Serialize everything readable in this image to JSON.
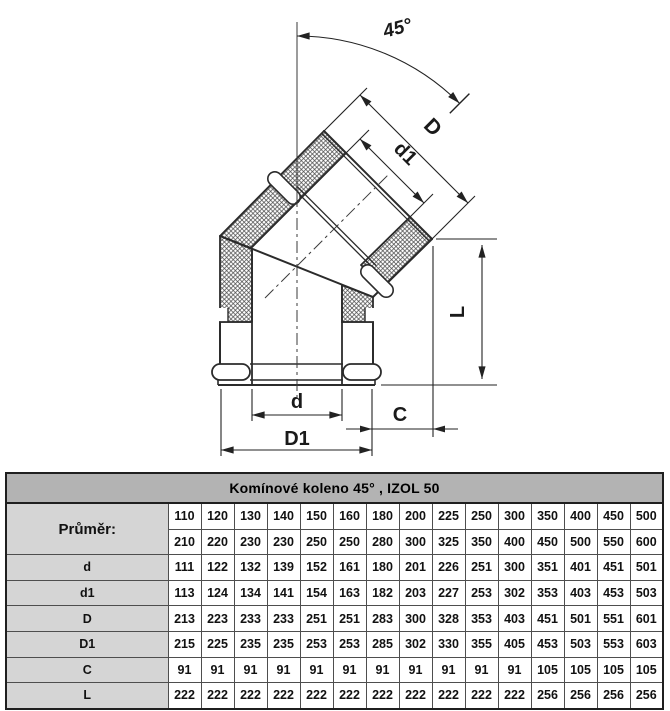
{
  "drawing": {
    "labels": {
      "angle": "45°",
      "D": "D",
      "d1": "d1",
      "d": "d",
      "D1": "D1",
      "C": "C",
      "L": "L"
    }
  },
  "table": {
    "title": "Komínové koleno 45° , IZOL 50",
    "rows": [
      {
        "label": "Průměr:",
        "rowspan": 2,
        "main": true,
        "values": [
          "110",
          "120",
          "130",
          "140",
          "150",
          "160",
          "180",
          "200",
          "225",
          "250",
          "300",
          "350",
          "400",
          "450",
          "500"
        ]
      },
      {
        "label": null,
        "values": [
          "210",
          "220",
          "230",
          "230",
          "250",
          "250",
          "280",
          "300",
          "325",
          "350",
          "400",
          "450",
          "500",
          "550",
          "600"
        ]
      },
      {
        "label": "d",
        "values": [
          "111",
          "122",
          "132",
          "139",
          "152",
          "161",
          "180",
          "201",
          "226",
          "251",
          "300",
          "351",
          "401",
          "451",
          "501"
        ]
      },
      {
        "label": "d1",
        "values": [
          "113",
          "124",
          "134",
          "141",
          "154",
          "163",
          "182",
          "203",
          "227",
          "253",
          "302",
          "353",
          "403",
          "453",
          "503"
        ]
      },
      {
        "label": "D",
        "values": [
          "213",
          "223",
          "233",
          "233",
          "251",
          "251",
          "283",
          "300",
          "328",
          "353",
          "403",
          "451",
          "501",
          "551",
          "601"
        ]
      },
      {
        "label": "D1",
        "values": [
          "215",
          "225",
          "235",
          "235",
          "253",
          "253",
          "285",
          "302",
          "330",
          "355",
          "405",
          "453",
          "503",
          "553",
          "603"
        ]
      },
      {
        "label": "C",
        "values": [
          "91",
          "91",
          "91",
          "91",
          "91",
          "91",
          "91",
          "91",
          "91",
          "91",
          "91",
          "105",
          "105",
          "105",
          "105"
        ]
      },
      {
        "label": "L",
        "values": [
          "222",
          "222",
          "222",
          "222",
          "222",
          "222",
          "222",
          "222",
          "222",
          "222",
          "222",
          "256",
          "256",
          "256",
          "256"
        ]
      }
    ]
  },
  "colors": {
    "header_bg": "#b3b3b3",
    "label_bg": "#d5d5d5",
    "table_border": "#1f1f1f",
    "cell_border": "#4e4e4e",
    "line": "#2b2b2b"
  }
}
